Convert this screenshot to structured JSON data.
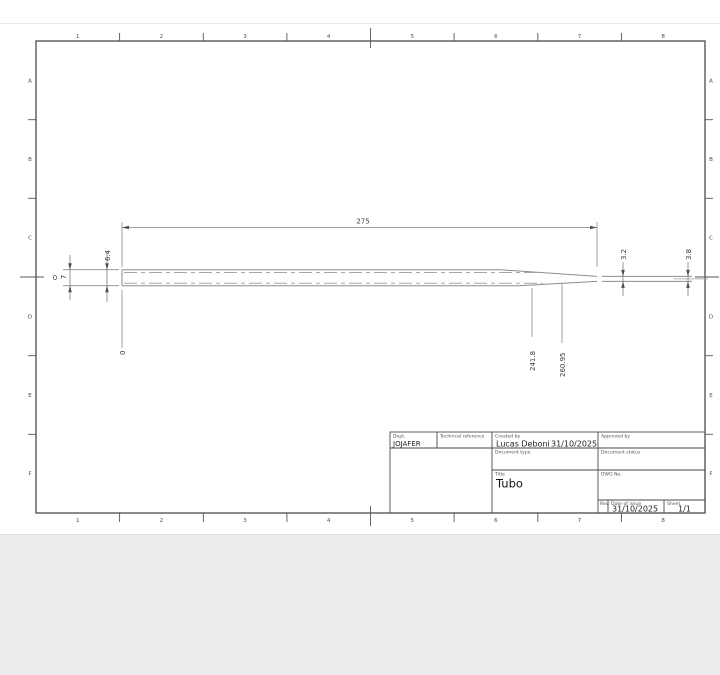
{
  "sheet": {
    "grid": {
      "columns": [
        "1",
        "2",
        "3",
        "4",
        "5",
        "6",
        "7",
        "8"
      ],
      "rows": [
        "A",
        "B",
        "C",
        "D",
        "E",
        "F"
      ]
    },
    "dimensions": {
      "total_length": "275",
      "outer_diameter": "6.4",
      "wall": {
        "value": "0.7",
        "whole": "0",
        "fraction": "7"
      },
      "tip_diameter_inner": "3.2",
      "tip_diameter_end": "3.8",
      "ordinate_zero": "0",
      "ordinate_a": "241.8",
      "ordinate_b": "260.95"
    },
    "title_block": {
      "dept_label": "Dept.",
      "dept_value": "JOJAFER",
      "technical_reference_label": "Technical reference",
      "created_by_label": "Created by",
      "created_by_value": "Lucas Deboni",
      "created_date": "31/10/2025",
      "approved_by_label": "Approved by",
      "document_type_label": "Document type",
      "document_status_label": "Document status",
      "title_label": "Title",
      "title_value": "Tubo",
      "dwg_no_label": "DWG No.",
      "rev_label": "Rev.",
      "date_of_issue_label": "Date of issue",
      "date_of_issue_value": "31/10/2025",
      "sheet_label": "Sheet",
      "sheet_value": "1/1"
    }
  },
  "colors": {
    "sheet_background": "#ffffff",
    "desktop_background": "#ececec",
    "frame_line": "#4a4a4a",
    "geometry_line": "#8c8c8c",
    "text": "#3c3c3c"
  }
}
